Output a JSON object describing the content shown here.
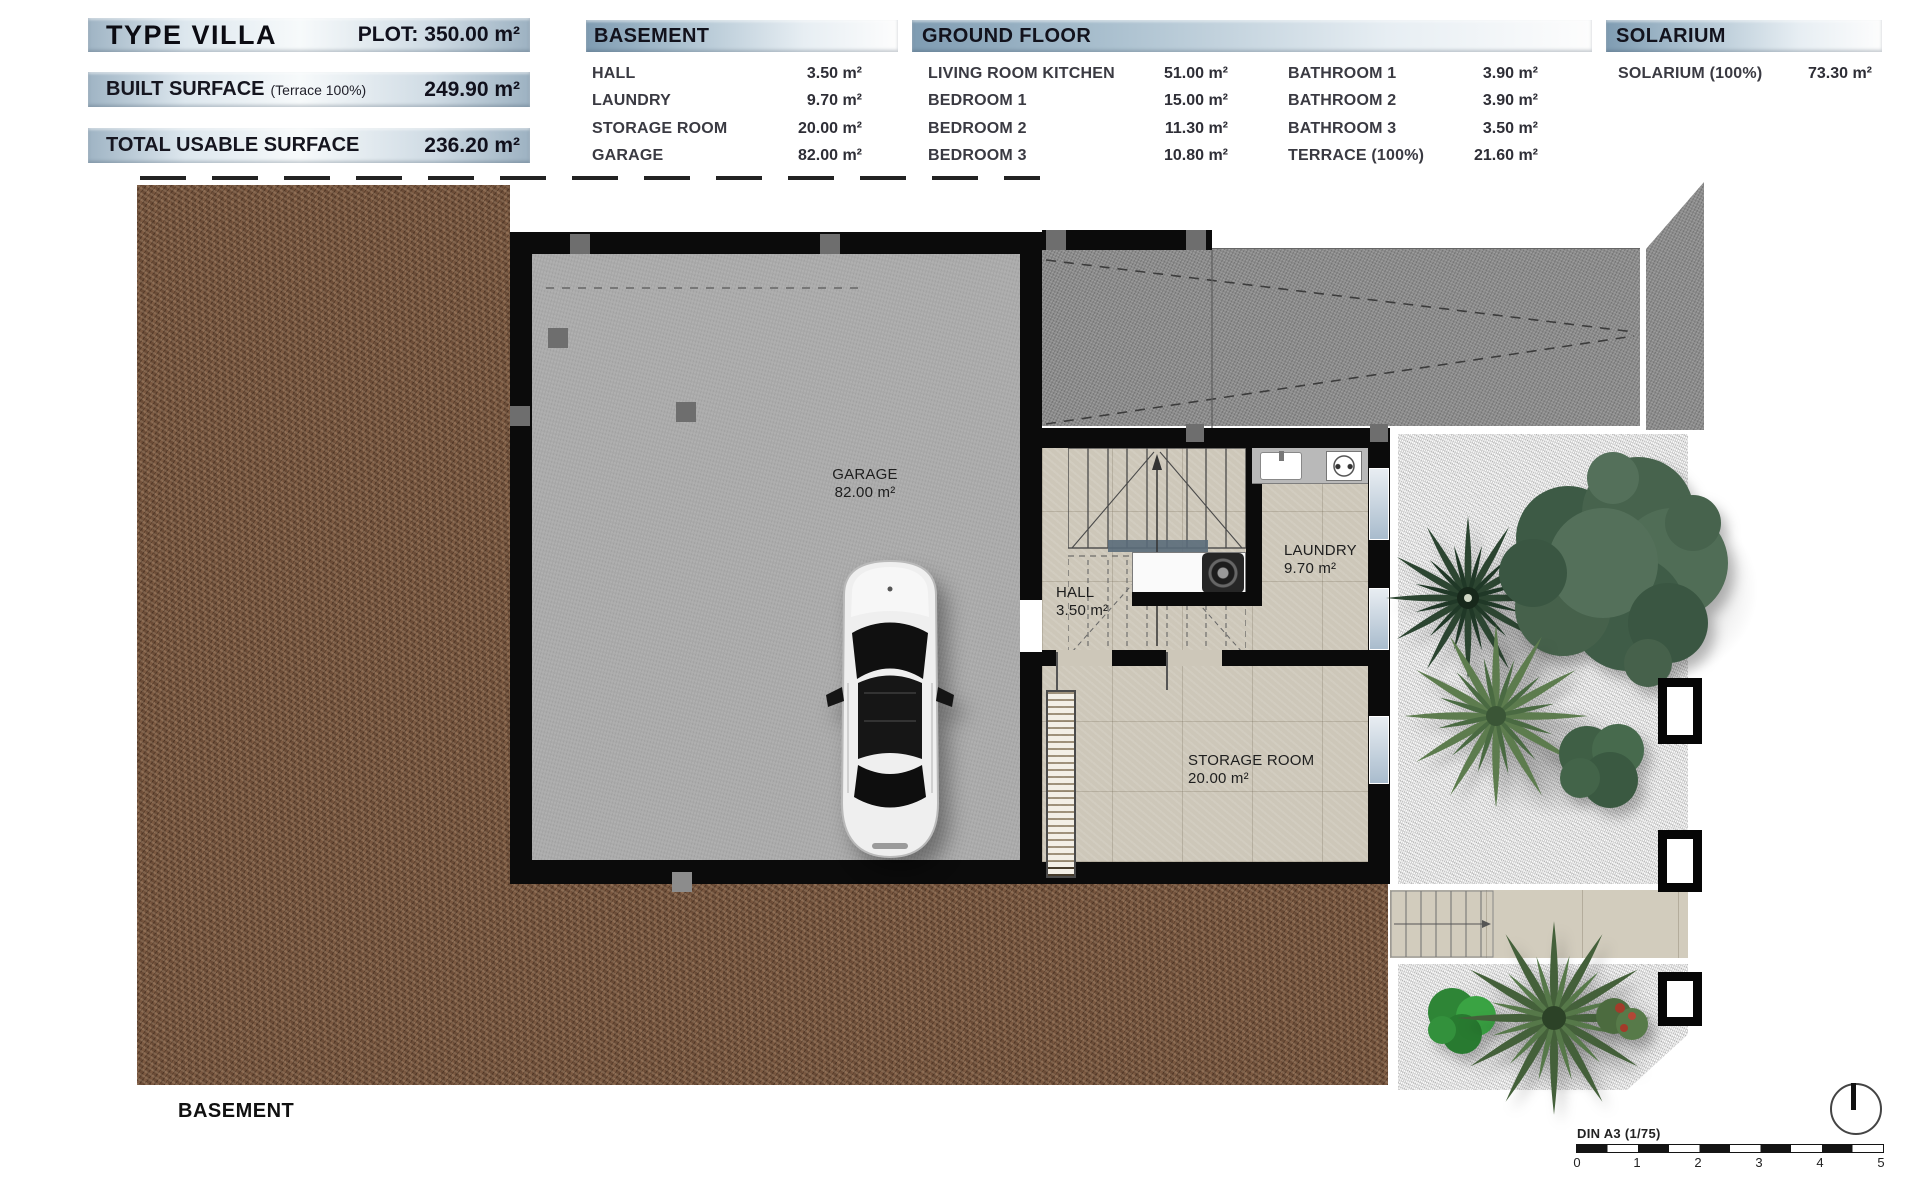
{
  "header": {
    "left_panel": {
      "title": "TYPE VILLA",
      "plot_label": "PLOT: 350.00 m²",
      "built_surface_label": "BUILT SURFACE",
      "built_surface_note": "(Terrace 100%)",
      "built_surface_value": "249.90 m²",
      "usable_label": "TOTAL USABLE SURFACE",
      "usable_value": "236.20 m²"
    },
    "basement_table": {
      "title": "BASEMENT",
      "rows": [
        {
          "label": "HALL",
          "value": "3.50 m²"
        },
        {
          "label": "LAUNDRY",
          "value": "9.70 m²"
        },
        {
          "label": "STORAGE ROOM",
          "value": "20.00 m²"
        },
        {
          "label": "GARAGE",
          "value": "82.00 m²"
        }
      ]
    },
    "ground_floor_table": {
      "title": "GROUND FLOOR",
      "col1": [
        {
          "label": "LIVING ROOM KITCHEN",
          "value": "51.00 m²"
        },
        {
          "label": "BEDROOM 1",
          "value": "15.00 m²"
        },
        {
          "label": "BEDROOM 2",
          "value": "11.30 m²"
        },
        {
          "label": "BEDROOM 3",
          "value": "10.80 m²"
        }
      ],
      "col2": [
        {
          "label": "BATHROOM 1",
          "value": "3.90 m²"
        },
        {
          "label": "BATHROOM 2",
          "value": "3.90 m²"
        },
        {
          "label": "BATHROOM 3",
          "value": "3.50 m²"
        },
        {
          "label": "TERRACE (100%)",
          "value": "21.60 m²"
        }
      ]
    },
    "solarium_table": {
      "title": "SOLARIUM",
      "rows": [
        {
          "label": "SOLARIUM (100%)",
          "value": "73.30 m²"
        }
      ]
    }
  },
  "plan": {
    "rooms": {
      "garage": {
        "name": "GARAGE",
        "area": "82.00 m²"
      },
      "hall": {
        "name": "HALL",
        "area": "3.50 m²"
      },
      "laundry": {
        "name": "LAUNDRY",
        "area": "9.70 m²"
      },
      "storage": {
        "name": "STORAGE ROOM",
        "area": "20.00 m²"
      }
    },
    "caption": "BASEMENT"
  },
  "footer": {
    "scale_label": "DIN A3 (1/75)",
    "scale_ticks": [
      "0",
      "1",
      "2",
      "3",
      "4",
      "5"
    ]
  },
  "colors": {
    "header_accent": "#7f9cb2",
    "wall": "#0b0b0b",
    "dirt": "#6b4c37",
    "garage_floor": "#ababab",
    "driveway": "#8d8d8d",
    "tile_floor": "#cdc7b9",
    "gravel": "#dcdcdc",
    "tree_green": "#47634d"
  }
}
